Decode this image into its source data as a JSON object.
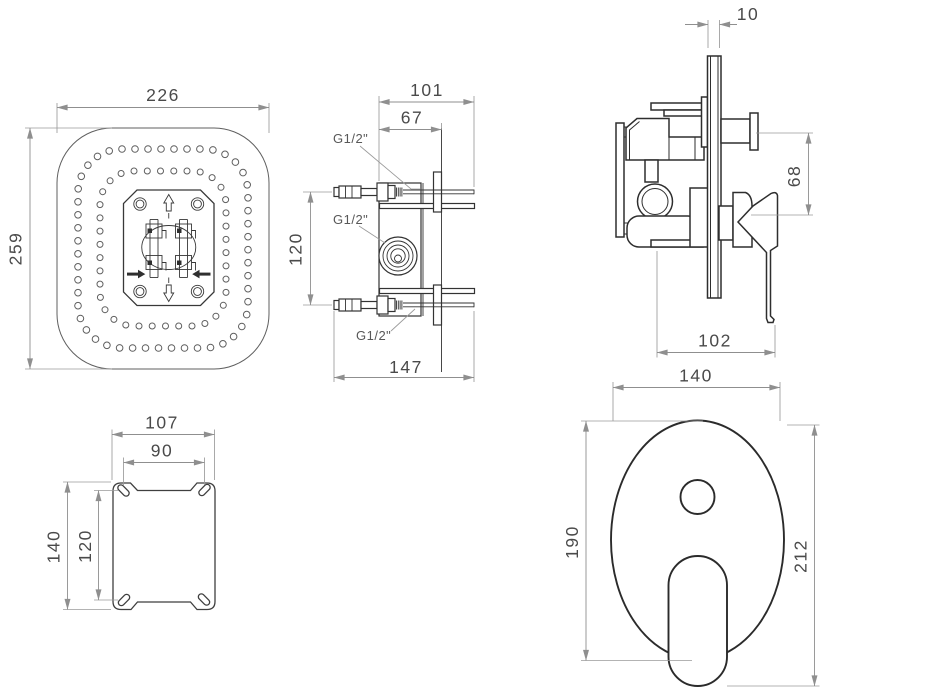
{
  "drawing_type": "technical dimension drawing - concealed shower mixer set",
  "colors": {
    "background": "#ffffff",
    "outline": "#2e2e2e",
    "thin_line": "#5f5f5f",
    "dimension_line": "#8f8f8f",
    "dimension_text": "#4a4a4a"
  },
  "views": {
    "showerhead_top": {
      "title": "overhead shower - top view",
      "dims": {
        "width": "226",
        "height": "259"
      },
      "nozzle_rings": {
        "outer_holes": 51,
        "inner_holes": 38
      }
    },
    "valve_side": {
      "title": "concealed valve - side view",
      "dims": {
        "depth_total": "101",
        "depth_to_wall": "67",
        "port_spacing": "120",
        "width_total": "147"
      },
      "ports": {
        "top": "G1/2\"",
        "middle": "G1/2\"",
        "bottom": "G1/2\""
      }
    },
    "mixer_side": {
      "title": "mixer trim - side view",
      "dims": {
        "plate_thickness": "10",
        "knob_to_handle": "68",
        "handle_depth": "102"
      }
    },
    "mounting_plate": {
      "title": "mounting plate - front view",
      "dims": {
        "width": "107",
        "slot_spacing_x": "90",
        "height": "140",
        "slot_spacing_y": "120"
      }
    },
    "trim_front": {
      "title": "trim plate - front view",
      "dims": {
        "plate_width": "140",
        "plate_height": "190",
        "total_height": "212"
      }
    }
  }
}
